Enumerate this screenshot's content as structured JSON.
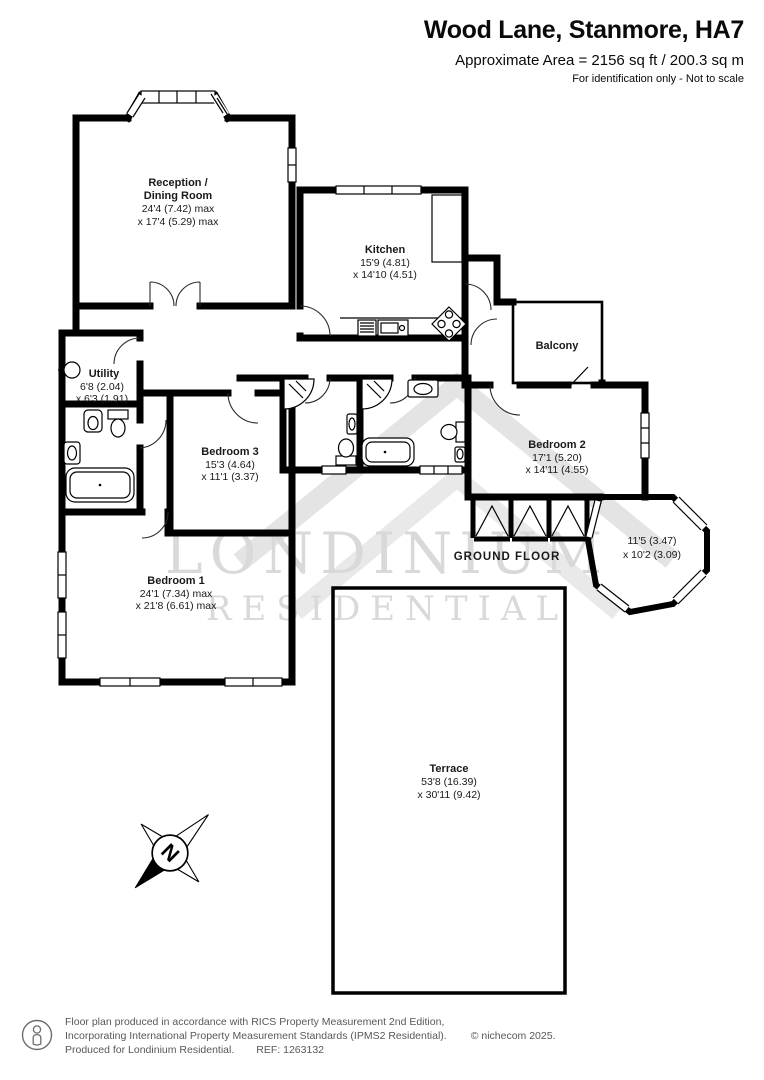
{
  "header": {
    "title": "Wood Lane, Stanmore, HA7",
    "area_line": "Approximate Area = 2156 sq ft / 200.3 sq m",
    "disclaimer": "For identification only - Not to scale"
  },
  "watermark": {
    "line1": "LONDINIUM",
    "line2": "RESIDENTIAL"
  },
  "floor_label": "GROUND FLOOR",
  "compass_letter": "N",
  "rooms": {
    "reception": {
      "name_line1": "Reception /",
      "name_line2": "Dining Room",
      "dim_line1": "24'4 (7.42) max",
      "dim_line2": "x 17'4 (5.29) max"
    },
    "kitchen": {
      "name": "Kitchen",
      "dim_line1": "15'9 (4.81)",
      "dim_line2": "x 14'10 (4.51)"
    },
    "balcony": {
      "name": "Balcony"
    },
    "utility": {
      "name": "Utility",
      "dim_line1": "6'8 (2.04)",
      "dim_line2": "x 6'3 (1.91)"
    },
    "bedroom3": {
      "name": "Bedroom 3",
      "dim_line1": "15'3 (4.64)",
      "dim_line2": "x 11'1 (3.37)"
    },
    "bedroom2": {
      "name": "Bedroom 2",
      "dim_line1": "17'1 (5.20)",
      "dim_line2": "x 14'11 (4.55)"
    },
    "bedroom1": {
      "name": "Bedroom 1",
      "dim_line1": "24'1 (7.34) max",
      "dim_line2": "x 21'8 (6.61) max"
    },
    "bay_window": {
      "dim_line1": "11'5 (3.47)",
      "dim_line2": "x 10'2 (3.09)"
    },
    "terrace": {
      "name": "Terrace",
      "dim_line1": "53'8 (16.39)",
      "dim_line2": "x 30'11 (9.42)"
    }
  },
  "footer": {
    "line1": "Floor plan produced in accordance with RICS Property Measurement 2nd Edition,",
    "line2": "Incorporating International Property Measurement Standards (IPMS2 Residential).",
    "copyright": "© nichecom 2025.",
    "line3": "Produced for Londinium Residential.",
    "ref": "REF: 1263132"
  },
  "colors": {
    "wall": "#000000",
    "watermark": "#d9d9d9",
    "footer_text": "#57585a"
  }
}
